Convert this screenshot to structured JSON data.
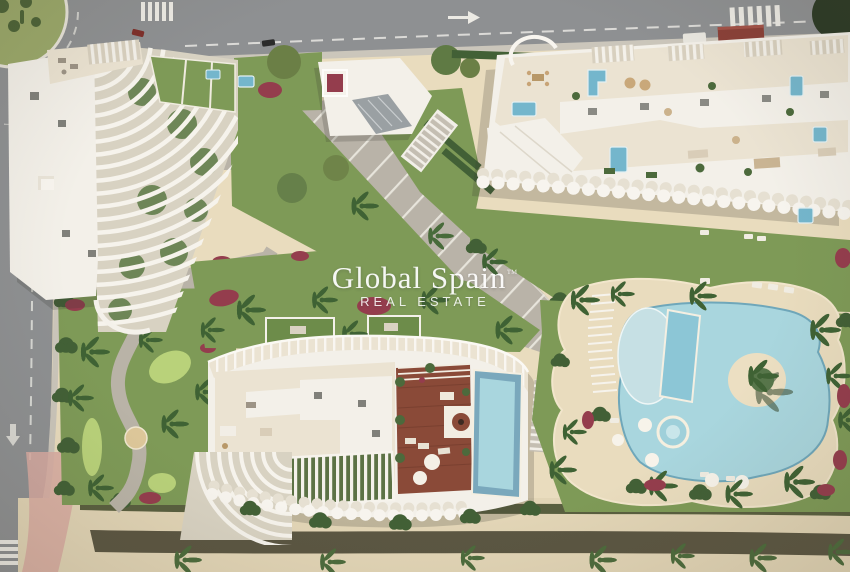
{
  "watermark": {
    "title": "Global Spain",
    "trademark": "™",
    "subtitle": "REAL ESTATE",
    "color": "#ffffff"
  },
  "palette": {
    "asphalt": "#8e9092",
    "road_marking": "#e9e8e3",
    "path_gray": "#b9b3a8",
    "sand_deck": "#e9dcbe",
    "beach_sand": "#e2d5b6",
    "building_white": "#f3f0e9",
    "terrace_cream": "#ebe3d2",
    "lawn": "#7e9a57",
    "putting_green": "#b9d27a",
    "hedge_dark": "#426036",
    "pool_blue": "#a9d6de",
    "pool_deep": "#74b6cc",
    "wood_deck": "#8a4a38",
    "flower_red": "#943d4d",
    "walk_pink": "#d9aca2"
  }
}
